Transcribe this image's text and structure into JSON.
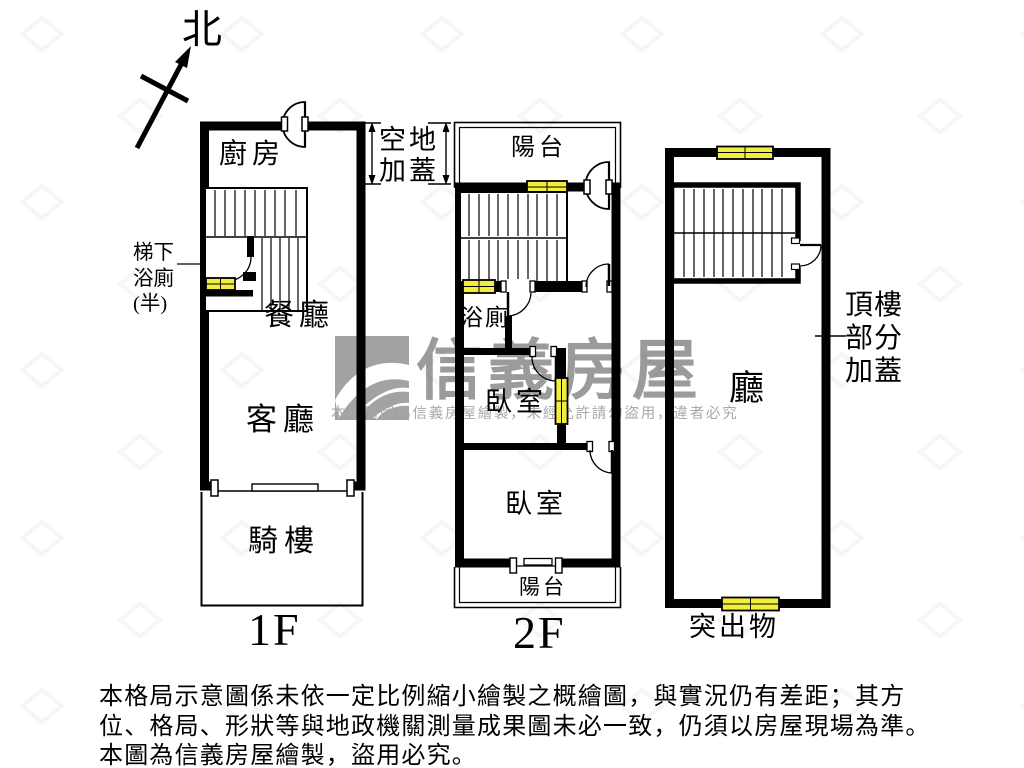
{
  "compass": {
    "north": "北"
  },
  "floor1": {
    "kitchen": "廚房",
    "under_stair_note": {
      "line1": "梯下",
      "line2": "浴廁",
      "line3": "(半)"
    },
    "dining": "餐廳",
    "living": "客廳",
    "arcade": "騎樓",
    "label": "1F"
  },
  "open_area_note": {
    "line1": "空地",
    "line2": "加蓋"
  },
  "floor2": {
    "balcony_top": "陽台",
    "bathroom": "浴廁",
    "bedroom_upper": "臥室",
    "bedroom_lower": "臥室",
    "balcony_bottom": "陽台",
    "label": "2F"
  },
  "rooftop": {
    "hall": "廳",
    "note": {
      "line1": "頂樓",
      "line2": "部分",
      "line3": "加蓋"
    },
    "protrusion": "突出物"
  },
  "watermark": {
    "brand": "信義房屋",
    "notice": "本格局圖為信義房屋繪製，未經允許請勿盜用，違者必究"
  },
  "disclaimer": {
    "line1": "本格局示意圖係未依一定比例縮小繪製之概繪圖，與實況仍有差距；其方",
    "line2": "位、格局、形狀等與地政機關測量成果圖未必一致，仍須以房屋現場為準。",
    "line3": "本圖為信義房屋繪製，盜用必究。"
  },
  "colors": {
    "wall": "#000000",
    "window_highlight": "#f2ee3d",
    "watermark_gray": "#9b9b9b"
  }
}
